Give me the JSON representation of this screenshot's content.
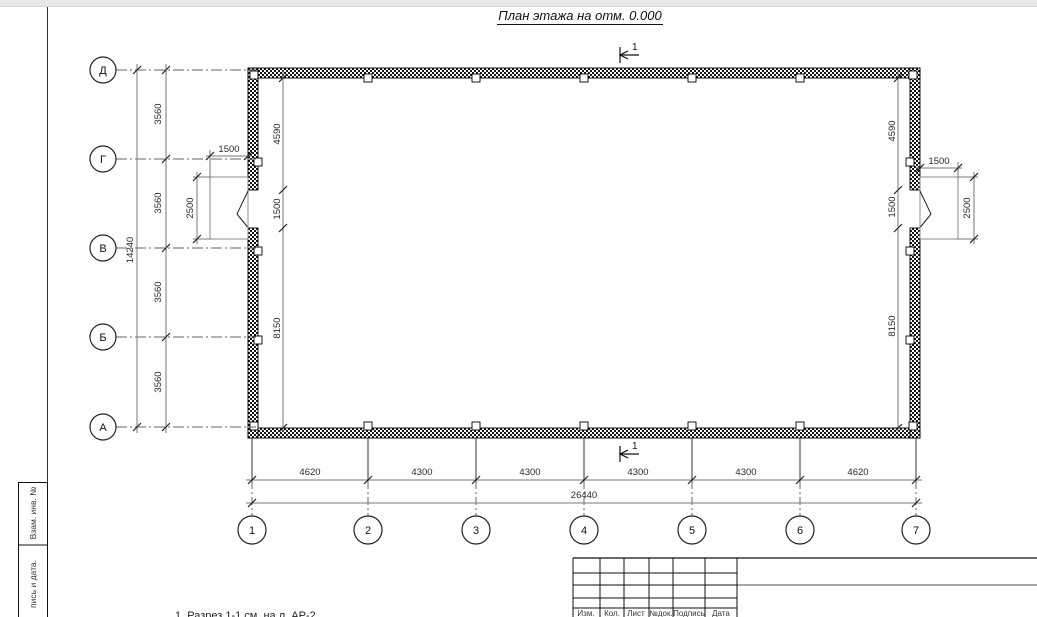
{
  "title": "План этажа на отм. 0.000",
  "sheet": {
    "stamp_fields": {
      "top": "Взам. инв. №",
      "bottom": "пись и дата."
    },
    "note": "1. Разрез 1-1 см. на л. АР-2",
    "title_block_headers": [
      "Изм.",
      "Кол.",
      "Лист",
      "№док.",
      "Подпись",
      "Дата"
    ]
  },
  "plan": {
    "row_axes": [
      "Д",
      "Г",
      "В",
      "Б",
      "А"
    ],
    "col_axes": [
      "1",
      "2",
      "3",
      "4",
      "5",
      "6",
      "7"
    ],
    "section_mark": "1",
    "dims": {
      "row_spacing": [
        "3560",
        "3560",
        "3560",
        "3560"
      ],
      "row_total": "14240",
      "left_wall_chain": [
        "4590",
        "1500",
        "8150"
      ],
      "right_wall_chain": [
        "4590",
        "1500",
        "8150"
      ],
      "left_porch": {
        "width": "1500",
        "depth": "2500"
      },
      "right_porch": {
        "width": "1500",
        "depth": "2500"
      },
      "col_spacing": [
        "4620",
        "4300",
        "4300",
        "4300",
        "4300",
        "4620"
      ],
      "col_total": "26440"
    }
  }
}
